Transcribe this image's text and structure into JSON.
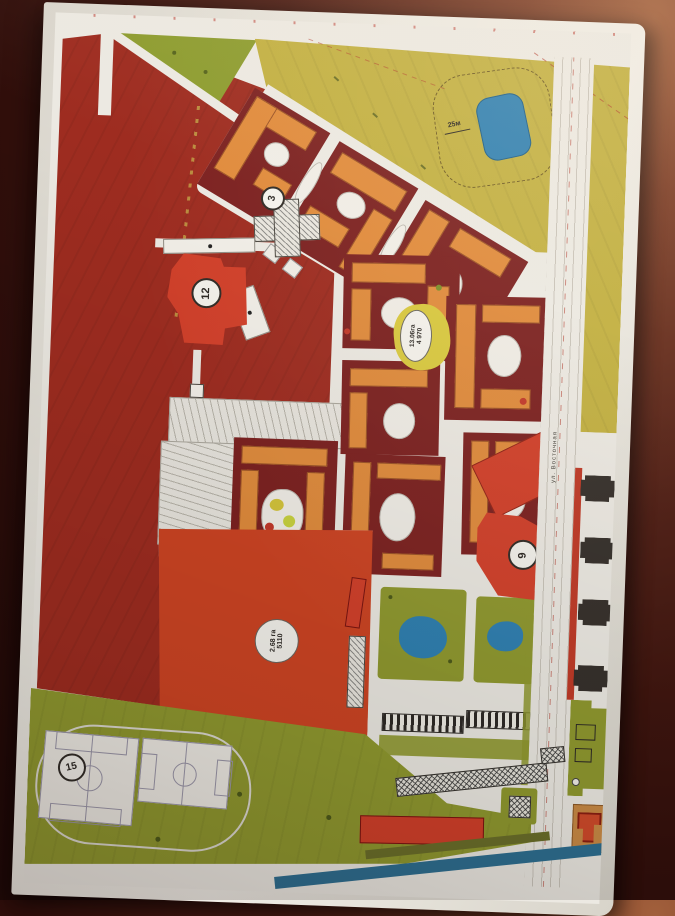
{
  "palette": {
    "road_white": "#ece9e2",
    "zone_red": "#9e2c20",
    "block_maroon": "#7c2120",
    "building_orange": "#e08b3c",
    "building_red": "#d2402a",
    "field_red_orange": "#cd4423",
    "zone_green": "#8d9c2f",
    "zone_yellow": "#c2b041",
    "olive_green": "#90992f",
    "water_blue": "#2f80b1",
    "canal_blue": "#2e6f91",
    "building_black": "#36302b",
    "paper": "#ece9e1",
    "background_dark": "#320f0b"
  },
  "markers": {
    "school": "3",
    "building_west": "12",
    "building_east": "9",
    "stadium": "15"
  },
  "labels": {
    "center_area": {
      "line1": "13.06га",
      "line2": "4 970"
    },
    "field_area": {
      "line1": "2.68 га",
      "line2": "5110"
    },
    "pond": "25м",
    "street": "ул. Восточная"
  }
}
